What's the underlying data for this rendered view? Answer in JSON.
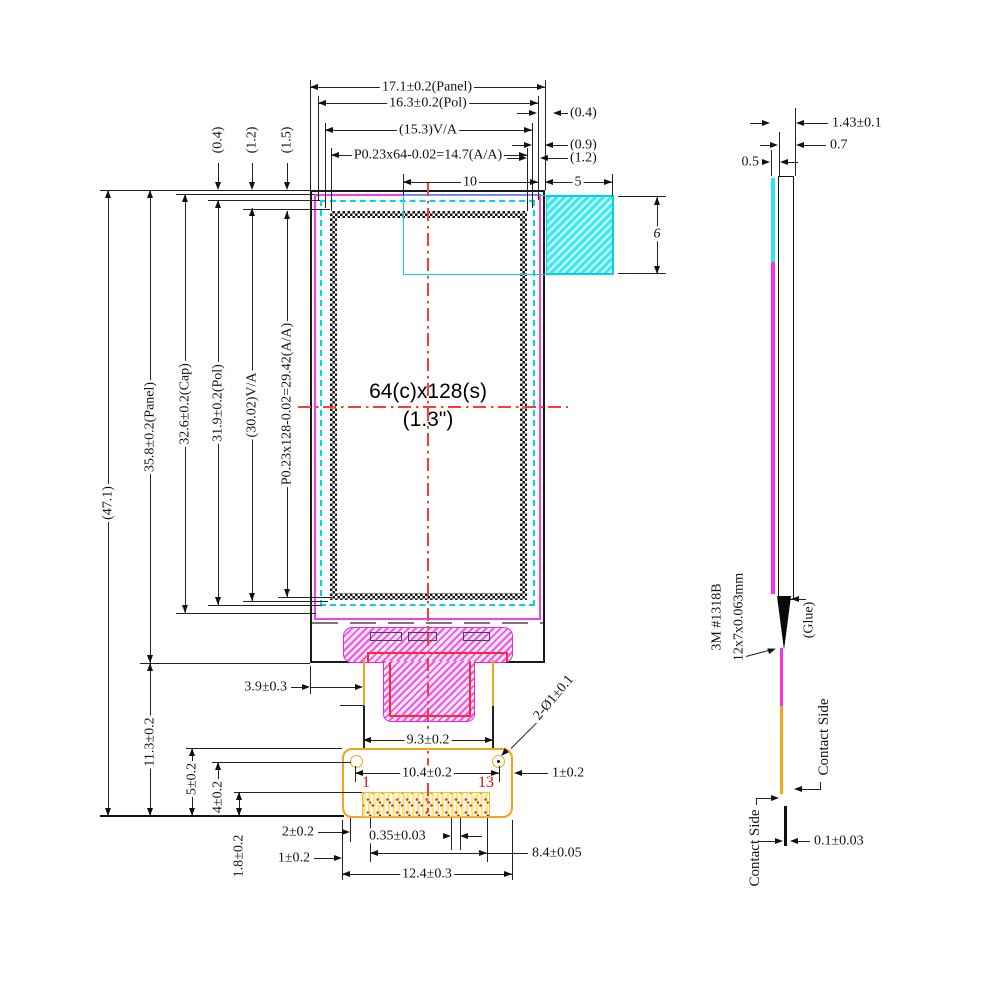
{
  "drawing": {
    "front": {
      "display": {
        "line1": "64(c)x128(s)",
        "line2": "(1.3\")"
      },
      "pins": {
        "first": "1",
        "last": "13"
      },
      "dims": {
        "panel_w": "17.1±0.2(Panel)",
        "pol_w": "16.3±0.2(Pol)",
        "va_w": "(15.3)V/A",
        "aa_w": "P0.23x64-0.02=14.7(A/A)",
        "gap_r1": "(0.4)",
        "gap_r2": "(0.9)",
        "gap_r3": "(1.2)",
        "pad_in": "10",
        "pad_out": "5",
        "pad_h": "6",
        "gap_t1": "(0.4)",
        "gap_t2": "(1.2)",
        "gap_t3": "(1.5)",
        "total_h": "(47.1)",
        "panel_h": "35.8±0.2(Panel)",
        "cap_h": "32.6±0.2(Cap)",
        "pol_h": "31.9±0.2(Pol)",
        "va_h": "(30.02)V/A",
        "aa_h": "P0.23x128-0.02=29.42(A/A)",
        "fpc_h": "11.3±0.2",
        "tail_offset": "3.9±0.3",
        "conn_top": "5±0.2",
        "hole_v": "4±0.2",
        "pin_v": "1.8±0.2",
        "tail_w": "9.3±0.2",
        "hole_cc": "10.4±0.2",
        "hole_edge": "1±0.2",
        "pin_margin": "2±0.2",
        "pin_w": "0.35±0.03",
        "pin_span": "8.4±0.05",
        "conn_edge": "1±0.2",
        "conn_w": "12.4±0.3",
        "holes": "2-Ø1±0.1"
      }
    },
    "side": {
      "dims": {
        "total_t": "1.43±0.1",
        "glass_t": "0.7",
        "film_t": "0.5",
        "fpc_t": "0.1±0.03"
      },
      "labels": {
        "tape1": "3M #1318B",
        "tape2": "12x7x0.063mm",
        "glue": "(Glue)",
        "contact_upper": "Contact Side",
        "contact_lower": "Contact Side"
      }
    }
  }
}
